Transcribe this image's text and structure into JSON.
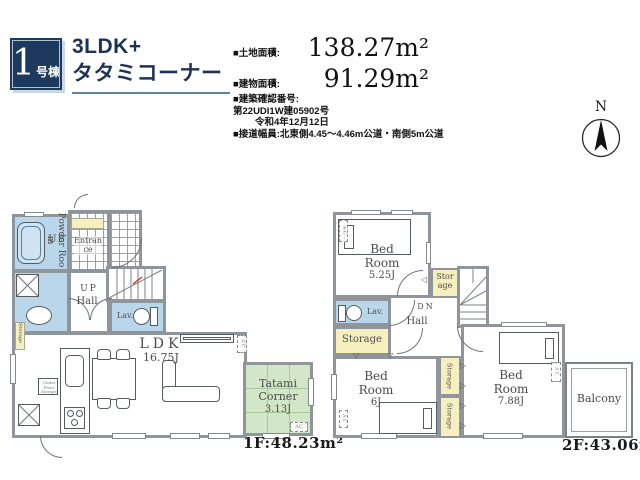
{
  "property": {
    "badge_number": "1",
    "badge_suffix": "号棟",
    "title_line1": "3LDK+",
    "title_line2": "タタミコーナー",
    "land_area_label": "■土地面積:",
    "land_area_value": "138.27m²",
    "building_area_label": "■建物面積:",
    "building_area_value": "91.29m²",
    "confirmation_label": "■建築確認番号:",
    "confirmation_number": "第22UDI1W建05902号",
    "confirmation_date": "令和4年12月12日",
    "road_info": "■接道幅員:北東側4.45〜4.46m公道・南側5m公道",
    "compass_north": "N"
  },
  "floor1": {
    "floor_label": "1F:48.23m²",
    "ub": "UB",
    "powder_room": "Powder Room",
    "entrance": "Entrance",
    "hall_up": "UP",
    "hall": "Hall",
    "lav": "Lav.",
    "ldk_name": "LDK",
    "ldk_size": "16.75J",
    "tatami_name": "Tatami Corner",
    "tatami_size": "3.13J",
    "storage": "Storage",
    "underfloor_storage": "Under Floor Storage",
    "ac": "AC"
  },
  "floor2": {
    "floor_label": "2F:43.06m²",
    "bedroom1_name": "Bed Room",
    "bedroom1_size": "5.25J",
    "bedroom2_name": "Bed Room",
    "bedroom2_size": "6J",
    "bedroom3_name": "Bed Room",
    "bedroom3_size": "7.88J",
    "storage": "Storage",
    "lav": "Lav.",
    "dn": "DN",
    "hall": "Hall",
    "balcony": "Balcony",
    "ac": "AC"
  },
  "colors": {
    "navy": "#1d3a5e",
    "underline_blue": "#5d83a8",
    "wall_gray": "#8f959b",
    "wet_area_blue": "#b9d6ea",
    "storage_yellow": "#f6efbe",
    "tatami_green": "#d2e6c8"
  }
}
